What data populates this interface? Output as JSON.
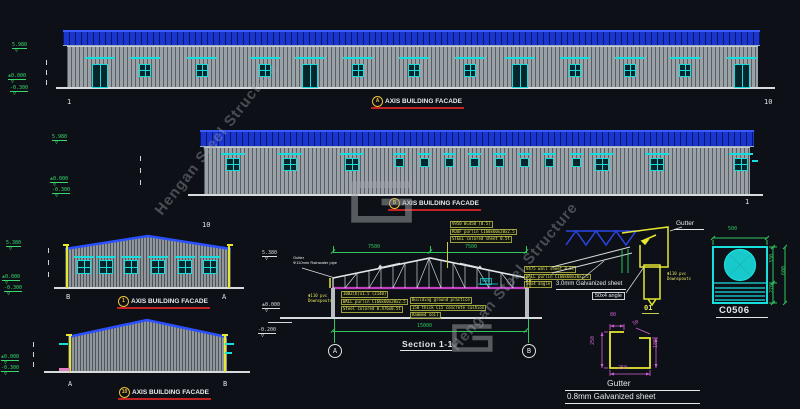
{
  "watermark": {
    "text": "Hengan Steel Structure"
  },
  "facade_a": {
    "title": "AXIS BUILDING FACADE",
    "bubble": "A",
    "grid_left": "1",
    "grid_right": "10",
    "elevations": [
      {
        "v": "5.980"
      },
      {
        "v": "±0.000"
      },
      {
        "v": "-0.300"
      }
    ]
  },
  "facade_b": {
    "title": "AXIS BUILDING FACADE",
    "bubble": "B",
    "grid_left": "10",
    "grid_right": "1",
    "elevations": [
      {
        "v": "5.980"
      },
      {
        "v": "±0.000"
      },
      {
        "v": "-0.300"
      }
    ]
  },
  "facade_1": {
    "title": "AXIS BUILDING FACADE",
    "bubble": "1",
    "grid_left": "B",
    "grid_right": "A",
    "elevations": [
      {
        "v": "5.380"
      },
      {
        "v": "±0.000"
      },
      {
        "v": "-0.300"
      }
    ]
  },
  "facade_10": {
    "title": "AXIS BUILDING FACADE",
    "bubble": "10",
    "grid_left": "A",
    "grid_right": "B",
    "elevations": [
      {
        "v": "±0.000"
      },
      {
        "v": "-0.300"
      }
    ]
  },
  "section": {
    "title": "Section 1-1",
    "bubble_left": "A",
    "bubble_right": "B",
    "dim_top_left": "7500",
    "dim_top_right": "7500",
    "dim_bottom": "15000",
    "dim_chord": "900",
    "elevations": [
      {
        "v": "5.380"
      },
      {
        "v": "±0.000"
      },
      {
        "v": "-0.200"
      }
    ],
    "note_gutter": [
      "Gutter",
      "Φ110mm Rainwater pipe"
    ],
    "note_downspout": [
      "Φ110 pvc",
      "Downspouts"
    ],
    "note_roof": [
      "V950 W=450 (0.5)",
      "ROOF purlin C160x60x20x2.5",
      "STEEL colored sheet 0.5t"
    ],
    "note_wall": [
      "100Z(b)x1.5 (Z140)",
      "WALL purlin C160x60x20x2.5",
      "Steel colored 0.476x0.5t"
    ],
    "note_ground": [
      "Building ground practice",
      "150 thick C15 concrete cushion",
      "Rammed soil"
    ],
    "note_col": [
      "V475 wall sheet 0.5t",
      "WALL purlin C160x60x20x2.5",
      "50x4 angle"
    ]
  },
  "eave_detail": {
    "gutter_label": "Gutter",
    "galvanized_label": "3.0mm Galvanized sheet",
    "angle_label": "50x4 angle",
    "downspout": [
      "Φ110 pvc",
      "Downspouts"
    ],
    "detail_no": "01"
  },
  "gutter_detail": {
    "name": "Gutter",
    "material": "0.8mm Galvanized sheet",
    "dim_top_left": "80",
    "dim_top_right": "50",
    "dim_left": "250",
    "dim_right": "180",
    "dim_bottom": "250"
  },
  "fan_detail": {
    "label": "C0506",
    "dim_width": "500",
    "dim_upper": "330",
    "dim_lower": "270",
    "dim_total": "600"
  },
  "drawing": {
    "features": [
      {
        "c": "lintel",
        "x": 85,
        "y": 57,
        "w": 30,
        "h": 2
      },
      {
        "c": "lintel",
        "x": 130,
        "y": 57,
        "w": 30,
        "h": 2
      },
      {
        "c": "lintel",
        "x": 187,
        "y": 57,
        "w": 30,
        "h": 2
      },
      {
        "c": "lintel",
        "x": 250,
        "y": 57,
        "w": 30,
        "h": 2
      },
      {
        "c": "lintel",
        "x": 295,
        "y": 57,
        "w": 30,
        "h": 2
      },
      {
        "c": "lintel",
        "x": 343,
        "y": 57,
        "w": 30,
        "h": 2
      },
      {
        "c": "lintel",
        "x": 399,
        "y": 57,
        "w": 30,
        "h": 2
      },
      {
        "c": "lintel",
        "x": 455,
        "y": 57,
        "w": 30,
        "h": 2
      },
      {
        "c": "lintel",
        "x": 505,
        "y": 57,
        "w": 30,
        "h": 2
      },
      {
        "c": "lintel",
        "x": 560,
        "y": 57,
        "w": 30,
        "h": 2
      },
      {
        "c": "lintel",
        "x": 615,
        "y": 57,
        "w": 30,
        "h": 2
      },
      {
        "c": "lintel",
        "x": 670,
        "y": 57,
        "w": 30,
        "h": 2
      },
      {
        "c": "lintel",
        "x": 727,
        "y": 57,
        "w": 30,
        "h": 2
      },
      {
        "c": "door",
        "x": 92,
        "y": 64,
        "w": 16,
        "h": 24
      },
      {
        "c": "door",
        "x": 302,
        "y": 64,
        "w": 16,
        "h": 24
      },
      {
        "c": "door",
        "x": 512,
        "y": 64,
        "w": 16,
        "h": 24
      },
      {
        "c": "door",
        "x": 734,
        "y": 64,
        "w": 16,
        "h": 24
      },
      {
        "c": "win",
        "x": 139,
        "y": 64,
        "w": 12,
        "h": 13
      },
      {
        "c": "win",
        "x": 196,
        "y": 64,
        "w": 12,
        "h": 13
      },
      {
        "c": "win",
        "x": 259,
        "y": 64,
        "w": 12,
        "h": 13
      },
      {
        "c": "win",
        "x": 352,
        "y": 64,
        "w": 12,
        "h": 13
      },
      {
        "c": "win",
        "x": 408,
        "y": 64,
        "w": 12,
        "h": 13
      },
      {
        "c": "win",
        "x": 464,
        "y": 64,
        "w": 12,
        "h": 13
      },
      {
        "c": "win",
        "x": 569,
        "y": 64,
        "w": 12,
        "h": 13
      },
      {
        "c": "win",
        "x": 624,
        "y": 64,
        "w": 12,
        "h": 13
      },
      {
        "c": "win",
        "x": 679,
        "y": 64,
        "w": 12,
        "h": 13
      },
      {
        "c": "lintel",
        "x": 221,
        "y": 153,
        "w": 24,
        "h": 2
      },
      {
        "c": "lintel",
        "x": 278,
        "y": 153,
        "w": 24,
        "h": 2
      },
      {
        "c": "lintel",
        "x": 340,
        "y": 153,
        "w": 24,
        "h": 2
      },
      {
        "c": "lintel",
        "x": 590,
        "y": 153,
        "w": 24,
        "h": 2
      },
      {
        "c": "lintel",
        "x": 645,
        "y": 153,
        "w": 24,
        "h": 2
      },
      {
        "c": "lintel",
        "x": 729,
        "y": 153,
        "w": 24,
        "h": 2
      },
      {
        "c": "lintel",
        "x": 393,
        "y": 153,
        "w": 13,
        "h": 2
      },
      {
        "c": "lintel",
        "x": 418,
        "y": 153,
        "w": 13,
        "h": 2
      },
      {
        "c": "lintel",
        "x": 443,
        "y": 153,
        "w": 13,
        "h": 2
      },
      {
        "c": "lintel",
        "x": 468,
        "y": 153,
        "w": 13,
        "h": 2
      },
      {
        "c": "lintel",
        "x": 493,
        "y": 153,
        "w": 13,
        "h": 2
      },
      {
        "c": "lintel",
        "x": 518,
        "y": 153,
        "w": 13,
        "h": 2
      },
      {
        "c": "lintel",
        "x": 543,
        "y": 153,
        "w": 13,
        "h": 2
      },
      {
        "c": "lintel",
        "x": 570,
        "y": 153,
        "w": 13,
        "h": 2
      },
      {
        "c": "win",
        "x": 226,
        "y": 158,
        "w": 14,
        "h": 13
      },
      {
        "c": "win",
        "x": 283,
        "y": 158,
        "w": 14,
        "h": 13
      },
      {
        "c": "win",
        "x": 345,
        "y": 158,
        "w": 14,
        "h": 13
      },
      {
        "c": "win",
        "x": 595,
        "y": 158,
        "w": 14,
        "h": 13
      },
      {
        "c": "win",
        "x": 650,
        "y": 158,
        "w": 14,
        "h": 13
      },
      {
        "c": "win",
        "x": 734,
        "y": 158,
        "w": 14,
        "h": 13
      },
      {
        "c": "sq",
        "x": 395,
        "y": 158,
        "w": 9,
        "h": 9
      },
      {
        "c": "sq",
        "x": 420,
        "y": 158,
        "w": 9,
        "h": 9
      },
      {
        "c": "sq",
        "x": 445,
        "y": 158,
        "w": 9,
        "h": 9
      },
      {
        "c": "sq",
        "x": 470,
        "y": 158,
        "w": 9,
        "h": 9
      },
      {
        "c": "sq",
        "x": 495,
        "y": 158,
        "w": 9,
        "h": 9
      },
      {
        "c": "sq",
        "x": 520,
        "y": 158,
        "w": 9,
        "h": 9
      },
      {
        "c": "sq",
        "x": 545,
        "y": 158,
        "w": 9,
        "h": 9
      },
      {
        "c": "sq",
        "x": 572,
        "y": 158,
        "w": 9,
        "h": 9
      },
      {
        "c": "tc",
        "x": 752,
        "y": 160,
        "w": 6,
        "h": 2
      },
      {
        "c": "lintel",
        "x": 74,
        "y": 256,
        "w": 20,
        "h": 2
      },
      {
        "c": "lintel",
        "x": 96,
        "y": 256,
        "w": 20,
        "h": 2
      },
      {
        "c": "lintel",
        "x": 121,
        "y": 256,
        "w": 20,
        "h": 2
      },
      {
        "c": "lintel",
        "x": 148,
        "y": 256,
        "w": 20,
        "h": 2
      },
      {
        "c": "lintel",
        "x": 175,
        "y": 256,
        "w": 20,
        "h": 2
      },
      {
        "c": "lintel",
        "x": 200,
        "y": 256,
        "w": 20,
        "h": 2
      },
      {
        "c": "win",
        "x": 77,
        "y": 260,
        "w": 14,
        "h": 14
      },
      {
        "c": "win",
        "x": 99,
        "y": 260,
        "w": 14,
        "h": 14
      },
      {
        "c": "win",
        "x": 124,
        "y": 260,
        "w": 14,
        "h": 14
      },
      {
        "c": "win",
        "x": 151,
        "y": 260,
        "w": 14,
        "h": 14
      },
      {
        "c": "win",
        "x": 178,
        "y": 260,
        "w": 14,
        "h": 14
      },
      {
        "c": "win",
        "x": 203,
        "y": 260,
        "w": 14,
        "h": 14
      },
      {
        "c": "ds",
        "x": 66,
        "y": 246,
        "w": 2,
        "h": 42
      },
      {
        "c": "ds",
        "x": 228,
        "y": 246,
        "w": 2,
        "h": 42
      },
      {
        "c": "hook",
        "x": 63,
        "y": 244,
        "w": 6,
        "h": 2
      },
      {
        "c": "hook",
        "x": 227,
        "y": 244,
        "w": 6,
        "h": 2
      },
      {
        "c": "ds",
        "x": 69,
        "y": 336,
        "w": 2,
        "h": 36
      },
      {
        "c": "ds",
        "x": 224,
        "y": 336,
        "w": 2,
        "h": 36
      },
      {
        "c": "hook",
        "x": 66,
        "y": 334,
        "w": 6,
        "h": 2
      },
      {
        "c": "hook",
        "x": 222,
        "y": 334,
        "w": 6,
        "h": 2
      },
      {
        "c": "tc",
        "x": 59,
        "y": 343,
        "w": 9,
        "h": 2
      },
      {
        "c": "tc",
        "x": 225,
        "y": 343,
        "w": 9,
        "h": 2
      },
      {
        "c": "tc",
        "x": 225,
        "y": 352,
        "w": 7,
        "h": 2
      },
      {
        "c": "pink",
        "x": 59,
        "y": 368,
        "w": 11,
        "h": 3
      },
      {
        "c": "wt",
        "x": 46,
        "y": 60,
        "w": 1,
        "h": 5
      },
      {
        "c": "wt",
        "x": 46,
        "y": 70,
        "w": 1,
        "h": 5
      },
      {
        "c": "wt",
        "x": 46,
        "y": 80,
        "w": 1,
        "h": 5
      },
      {
        "c": "wt",
        "x": 140,
        "y": 156,
        "w": 1,
        "h": 5
      },
      {
        "c": "wt",
        "x": 140,
        "y": 168,
        "w": 1,
        "h": 5
      },
      {
        "c": "wt",
        "x": 140,
        "y": 180,
        "w": 1,
        "h": 5
      },
      {
        "c": "wt",
        "x": 48,
        "y": 248,
        "w": 1,
        "h": 5
      },
      {
        "c": "wt",
        "x": 48,
        "y": 260,
        "w": 1,
        "h": 5
      },
      {
        "c": "wt",
        "x": 48,
        "y": 272,
        "w": 1,
        "h": 5
      },
      {
        "c": "wt",
        "x": 33,
        "y": 342,
        "w": 1,
        "h": 5
      },
      {
        "c": "wt",
        "x": 33,
        "y": 352,
        "w": 1,
        "h": 5
      },
      {
        "c": "wt",
        "x": 33,
        "y": 362,
        "w": 1,
        "h": 5
      }
    ]
  }
}
